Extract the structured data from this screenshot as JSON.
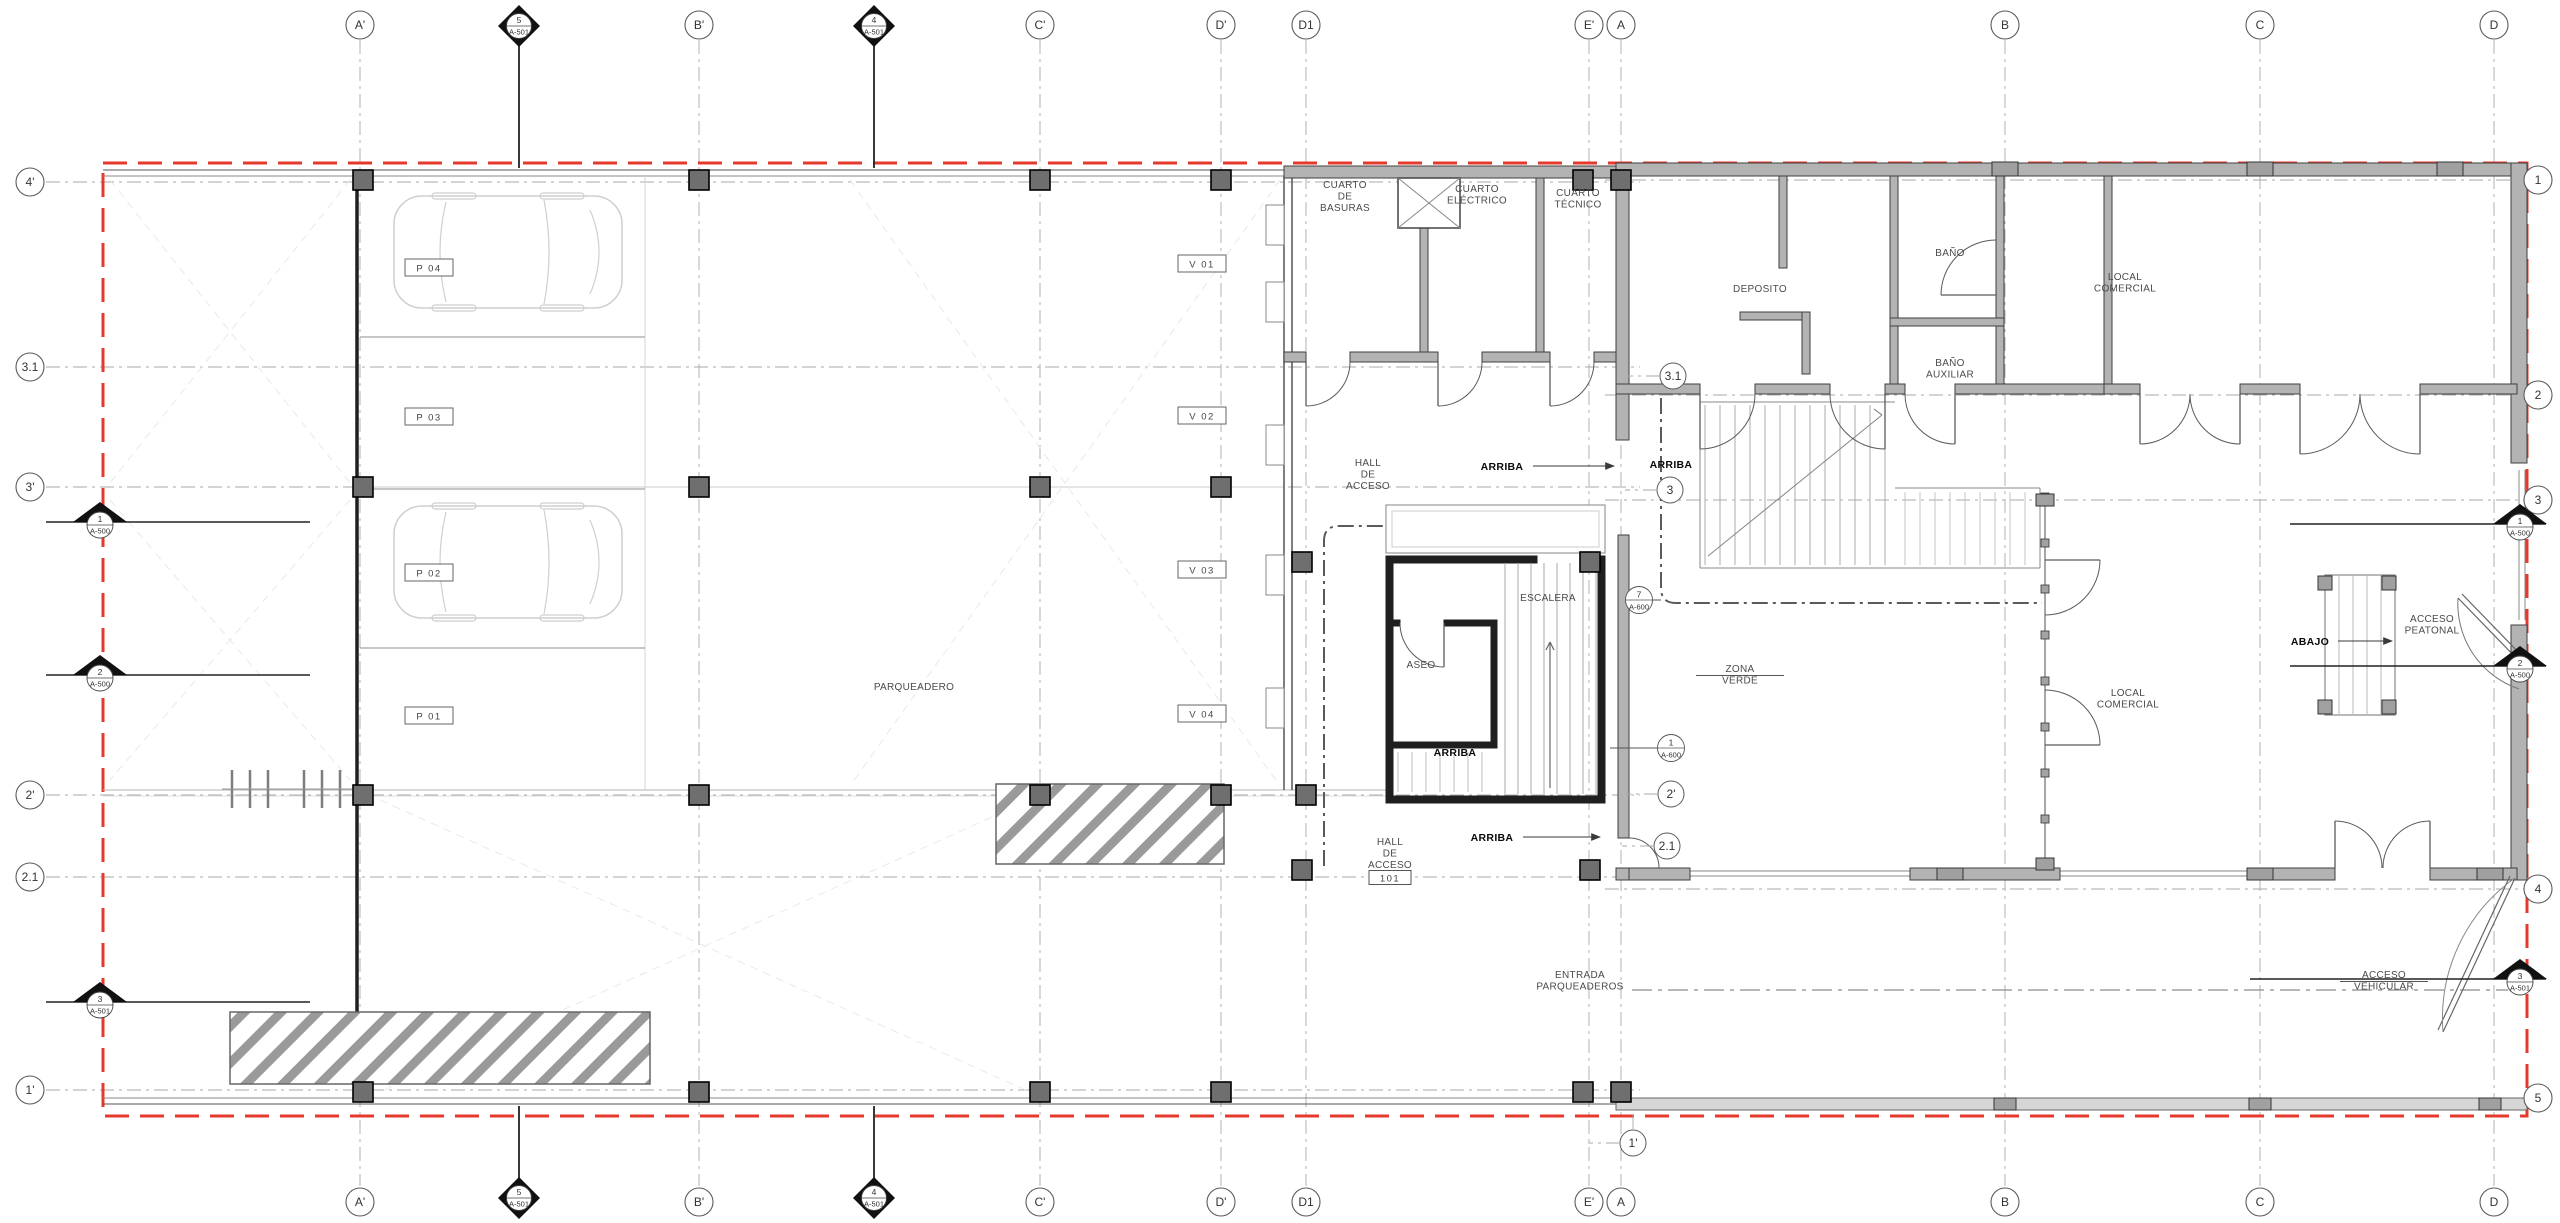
{
  "drawing": {
    "type_note": "first floor plan",
    "colors": {
      "boundary_red": "#e5392e",
      "wall_gray": "#b3b3b3",
      "column_dark": "#6f6f6f",
      "grid_gray": "#a8a8a8"
    }
  },
  "grid": {
    "top": [
      {
        "label": "A'",
        "x": 360
      },
      {
        "label": "B'",
        "x": 699
      },
      {
        "label": "C'",
        "x": 1040
      },
      {
        "label": "D'",
        "x": 1221
      },
      {
        "label": "D1",
        "x": 1306
      },
      {
        "label": "E'",
        "x": 1589
      },
      {
        "label": "A",
        "x": 1621
      },
      {
        "label": "B",
        "x": 2005
      },
      {
        "label": "C",
        "x": 2260
      },
      {
        "label": "D",
        "x": 2494
      }
    ],
    "bottom": [
      {
        "label": "A'",
        "x": 360
      },
      {
        "label": "B'",
        "x": 699
      },
      {
        "label": "C'",
        "x": 1040
      },
      {
        "label": "D'",
        "x": 1221
      },
      {
        "label": "D1",
        "x": 1306
      },
      {
        "label": "E'",
        "x": 1589
      },
      {
        "label": "A",
        "x": 1621
      },
      {
        "label": "B",
        "x": 2005
      },
      {
        "label": "C",
        "x": 2260
      },
      {
        "label": "D",
        "x": 2494
      }
    ],
    "left": [
      {
        "label": "4'",
        "y": 182
      },
      {
        "label": "3.1",
        "y": 367
      },
      {
        "label": "3'",
        "y": 487
      },
      {
        "label": "2'",
        "y": 795
      },
      {
        "label": "2.1",
        "y": 877
      },
      {
        "label": "1'",
        "y": 1090
      }
    ],
    "right": [
      {
        "label": "1",
        "y": 180
      },
      {
        "label": "2",
        "y": 395
      },
      {
        "label": "3",
        "y": 500
      },
      {
        "label": "4",
        "y": 889
      },
      {
        "label": "5",
        "y": 1098
      }
    ],
    "interior": [
      {
        "label": "3.1",
        "x": 1673,
        "y": 376
      },
      {
        "label": "3",
        "x": 1670,
        "y": 490
      },
      {
        "label": "2'",
        "x": 1671,
        "y": 794
      },
      {
        "label": "2.1",
        "x": 1667,
        "y": 846
      },
      {
        "label": "1'",
        "x": 1633,
        "y": 1143
      }
    ]
  },
  "section_markers": {
    "diamonds": [
      {
        "num": "5",
        "sheet": "A-501",
        "x": 519,
        "y": 26
      },
      {
        "num": "4",
        "sheet": "A-501",
        "x": 874,
        "y": 26
      },
      {
        "num": "5",
        "sheet": "A-501",
        "x": 519,
        "y": 1198
      },
      {
        "num": "4",
        "sheet": "A-501",
        "x": 874,
        "y": 1198
      }
    ],
    "triangles": [
      {
        "num": "1",
        "sheet": "A-500",
        "x": 100,
        "y": 522
      },
      {
        "num": "2",
        "sheet": "A-500",
        "x": 100,
        "y": 675
      },
      {
        "num": "3",
        "sheet": "A-501",
        "x": 100,
        "y": 1002
      },
      {
        "num": "1",
        "sheet": "A-500",
        "x": 2520,
        "y": 524
      },
      {
        "num": "2",
        "sheet": "A-500",
        "x": 2520,
        "y": 666
      },
      {
        "num": "3",
        "sheet": "A-501",
        "x": 2520,
        "y": 979
      }
    ],
    "details": [
      {
        "num": "7",
        "sheet": "A-600",
        "x": 1639,
        "y": 600
      },
      {
        "num": "1",
        "sheet": "A-600",
        "x": 1671,
        "y": 748
      }
    ]
  },
  "rooms": [
    {
      "id": "cuarto-de-basuras",
      "x": 1345,
      "y": 188,
      "lines": [
        "CUARTO",
        "DE",
        "BASURAS"
      ]
    },
    {
      "id": "cuarto-electrico",
      "x": 1477,
      "y": 192,
      "lines": [
        "CUARTO",
        "ELÉCTRICO"
      ]
    },
    {
      "id": "cuarto-tecnico",
      "x": 1578,
      "y": 196,
      "lines": [
        "CUARTO",
        "TÉCNICO"
      ]
    },
    {
      "id": "deposito",
      "x": 1760,
      "y": 292,
      "lines": [
        "DEPOSITO"
      ]
    },
    {
      "id": "bano",
      "x": 1950,
      "y": 256,
      "lines": [
        "BAÑO"
      ]
    },
    {
      "id": "bano-auxiliar",
      "x": 1950,
      "y": 366,
      "lines": [
        "BAÑO",
        "AUXILIAR"
      ]
    },
    {
      "id": "local-comercial-top",
      "x": 2125,
      "y": 280,
      "lines": [
        "LOCAL",
        "COMERCIAL"
      ]
    },
    {
      "id": "local-comercial-mid",
      "x": 2128,
      "y": 696,
      "lines": [
        "LOCAL",
        "COMERCIAL"
      ]
    },
    {
      "id": "hall-de-acceso-top",
      "x": 1368,
      "y": 466,
      "lines": [
        "HALL",
        "DE",
        "ACCESO"
      ]
    },
    {
      "id": "hall-de-acceso-low",
      "x": 1390,
      "y": 845,
      "lines": [
        "HALL",
        "DE",
        "ACCESO"
      ],
      "box": "101"
    },
    {
      "id": "escalera",
      "x": 1548,
      "y": 601,
      "lines": [
        "ESCALERA"
      ]
    },
    {
      "id": "aseo",
      "x": 1421,
      "y": 668,
      "lines": [
        "ASEO"
      ]
    },
    {
      "id": "arriba-stair",
      "x": 1455,
      "y": 756,
      "lines": [
        "ARRIBA"
      ],
      "bold": true
    },
    {
      "id": "arriba-hall",
      "x": 1502,
      "y": 470,
      "lines": [
        "ARRIBA"
      ],
      "bold": true,
      "arrow": {
        "x1": 1533,
        "x2": 1614,
        "y": 466
      }
    },
    {
      "id": "arriba-right",
      "x": 1671,
      "y": 468,
      "lines": [
        "ARRIBA"
      ],
      "bold": true
    },
    {
      "id": "arriba-hall-2",
      "x": 1492,
      "y": 841,
      "lines": [
        "ARRIBA"
      ],
      "bold": true,
      "arrow": {
        "x1": 1523,
        "x2": 1600,
        "y": 837
      }
    },
    {
      "id": "parqueadero",
      "x": 914,
      "y": 690,
      "lines": [
        "PARQUEADERO"
      ]
    },
    {
      "id": "zona-verde",
      "x": 1740,
      "y": 672,
      "lines": [
        "ZONA",
        "VERDE"
      ],
      "rule": true
    },
    {
      "id": "abajo",
      "x": 2310,
      "y": 645,
      "lines": [
        "ABAJO"
      ],
      "bold": true,
      "arrow": {
        "x1": 2338,
        "x2": 2392,
        "y": 641
      }
    },
    {
      "id": "acceso-peatonal",
      "x": 2432,
      "y": 622,
      "lines": [
        "ACCESO",
        "PEATONAL"
      ]
    },
    {
      "id": "acceso-vehicular",
      "x": 2384,
      "y": 978,
      "lines": [
        "ACCESO",
        "VEHICULAR"
      ],
      "rule": true
    },
    {
      "id": "entrada-parqueaderos",
      "x": 1580,
      "y": 978,
      "lines": [
        "ENTRADA",
        "PARQUEADEROS"
      ]
    }
  ],
  "parking_stalls": [
    {
      "code": "P 04",
      "x": 429,
      "y": 268
    },
    {
      "code": "P 03",
      "x": 429,
      "y": 417
    },
    {
      "code": "P 02",
      "x": 429,
      "y": 573
    },
    {
      "code": "P 01",
      "x": 429,
      "y": 716
    },
    {
      "code": "V 01",
      "x": 1202,
      "y": 264
    },
    {
      "code": "V 02",
      "x": 1202,
      "y": 416
    },
    {
      "code": "V 03",
      "x": 1202,
      "y": 570
    },
    {
      "code": "V 04",
      "x": 1202,
      "y": 714
    }
  ]
}
